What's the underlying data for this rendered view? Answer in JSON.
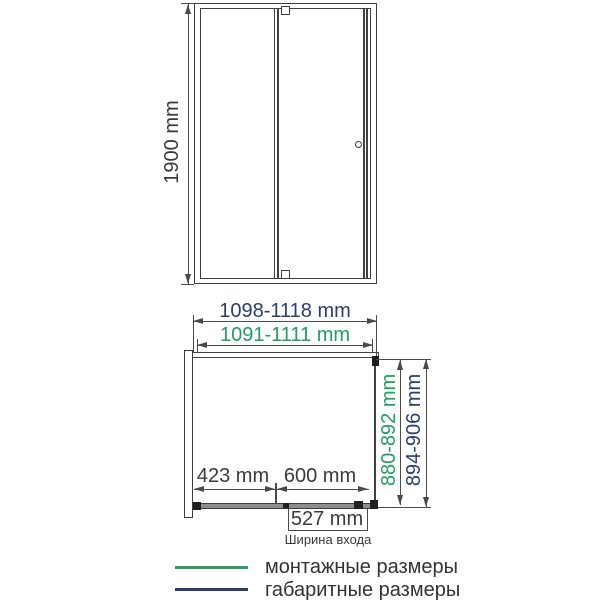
{
  "drawing_type": "shower-door-dimension-diagram",
  "front_view": {
    "height_label": "1900 mm"
  },
  "width_dims": {
    "overall": "1098-1118 mm",
    "mounting": "1091-1111 mm"
  },
  "plan_view": {
    "fixed_segment": "423 mm",
    "door_segment": "600 mm",
    "entry_width": "527 mm",
    "entry_caption": "Ширина входа",
    "depth_mounting": "880-892 mm",
    "depth_overall": "894-906 mm"
  },
  "legend": {
    "mounting_label": "монтажные размеры",
    "overall_label": "габаритные размеры"
  },
  "colors": {
    "mounting_green": "#21a061",
    "overall_navy": "#2c3d6e",
    "line_gray": "#4a4a4a",
    "panel_gray": "#8d8d8d"
  }
}
